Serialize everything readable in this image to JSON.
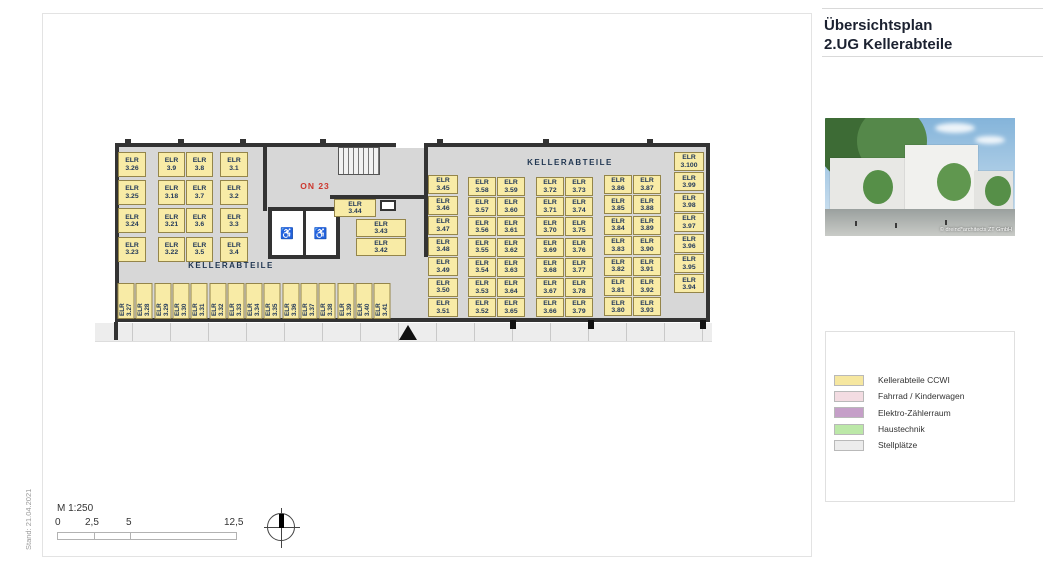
{
  "document": {
    "stand_note": "Stand: 21.04.2021",
    "title_line1": "Übersichtsplan",
    "title_line2": "2.UG Kellerabteile",
    "photo_credit": "© dreind*architects ZT GmbH"
  },
  "legend": {
    "items": [
      {
        "name": "kellerabteile-ccwi",
        "label": "Kellerabteile CCWI",
        "color": "#F6E7A0"
      },
      {
        "name": "fahrrad-kinderwagen",
        "label": "Fahrrad / Kinderwagen",
        "color": "#F3DCE2"
      },
      {
        "name": "elektro-zaehlerraum",
        "label": "Elektro-Zählerraum",
        "color": "#C59FC8"
      },
      {
        "name": "haustechnik",
        "label": "Haustechnik",
        "color": "#BCE8A8"
      },
      {
        "name": "stellplaetze",
        "label": "Stellplätze",
        "color": "#ECECEC"
      }
    ]
  },
  "plan": {
    "cell_prefix": "ELR",
    "zone_label_left": "KELLERABTEILE",
    "zone_label_right": "KELLERABTEILE",
    "room_label": "ON 23",
    "left_wing": {
      "wall_column": [
        "3.26",
        "3.25",
        "3.24",
        "3.23"
      ],
      "pair_column": [
        [
          "3.9",
          "3.8"
        ],
        [
          "3.18",
          "3.7"
        ],
        [
          "3.21",
          "3.6"
        ],
        [
          "3.22",
          "3.5"
        ]
      ],
      "single_column": [
        "3.1",
        "3.2",
        "3.3",
        "3.4"
      ],
      "bottom_row": [
        "3.27",
        "3.28",
        "3.29",
        "3.30",
        "3.31",
        "3.32",
        "3.33",
        "3.34",
        "3.35",
        "3.36",
        "3.37",
        "3.38",
        "3.39",
        "3.40",
        "3.41"
      ]
    },
    "middle": {
      "boxes": [
        "3.44",
        "3.43",
        "3.42"
      ]
    },
    "right_wing": {
      "col_a": [
        "3.45",
        "3.46",
        "3.47",
        "3.48",
        "3.49",
        "3.50",
        "3.51"
      ],
      "col_b": [
        [
          "3.58",
          "3.59"
        ],
        [
          "3.57",
          "3.60"
        ],
        [
          "3.56",
          "3.61"
        ],
        [
          "3.55",
          "3.62"
        ],
        [
          "3.54",
          "3.63"
        ],
        [
          "3.53",
          "3.64"
        ],
        [
          "3.52",
          "3.65"
        ]
      ],
      "col_c": [
        [
          "3.72",
          "3.73"
        ],
        [
          "3.71",
          "3.74"
        ],
        [
          "3.70",
          "3.75"
        ],
        [
          "3.69",
          "3.76"
        ],
        [
          "3.68",
          "3.77"
        ],
        [
          "3.67",
          "3.78"
        ],
        [
          "3.66",
          "3.79"
        ]
      ],
      "col_d": [
        [
          "3.86",
          "3.87"
        ],
        [
          "3.85",
          "3.88"
        ],
        [
          "3.84",
          "3.89"
        ],
        [
          "3.83",
          "3.90"
        ],
        [
          "3.82",
          "3.91"
        ],
        [
          "3.81",
          "3.92"
        ],
        [
          "3.80",
          "3.93"
        ]
      ],
      "col_e": [
        "3.100",
        "3.99",
        "3.98",
        "3.97",
        "3.96",
        "3.95",
        "3.94"
      ]
    }
  },
  "scalebar": {
    "label": "M 1:250",
    "ticks": [
      "0",
      "2,5",
      "5",
      "12,5"
    ]
  }
}
